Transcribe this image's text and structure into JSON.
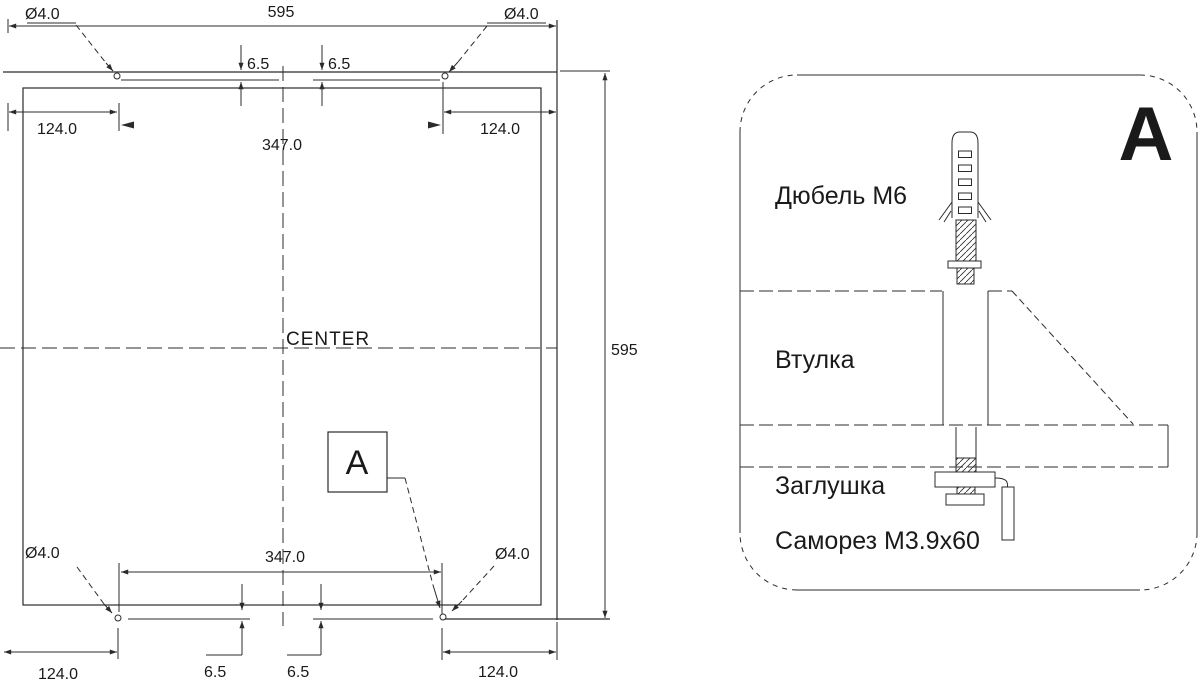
{
  "main_view": {
    "width_dim": "595",
    "height_dim": "595",
    "hole_dia_top_left": "Ø4.0",
    "hole_dia_top_right": "Ø4.0",
    "hole_dia_bottom_left": "Ø4.0",
    "hole_dia_bottom_right": "Ø4.0",
    "edge_offset_top_left": "124.0",
    "edge_offset_top_right": "124.0",
    "edge_offset_bottom_left": "124.0",
    "edge_offset_bottom_right": "124.0",
    "slot_offset_top_left": "6.5",
    "slot_offset_top_right": "6.5",
    "slot_offset_bottom_left": "6.5",
    "slot_offset_bottom_right": "6.5",
    "hole_spacing_top": "347.0",
    "hole_spacing_bottom": "347.0",
    "center_label": "CENTER",
    "detail_marker": "A"
  },
  "detail_view": {
    "title": "A",
    "part_labels": {
      "dowel": "Дюбель M6",
      "bushing": "Втулка",
      "plug": "Заглушка",
      "screw": "Саморез M3.9x60"
    }
  },
  "colors": {
    "line": "#2b2b2b",
    "text": "#1a1a1a",
    "background": "#ffffff"
  }
}
